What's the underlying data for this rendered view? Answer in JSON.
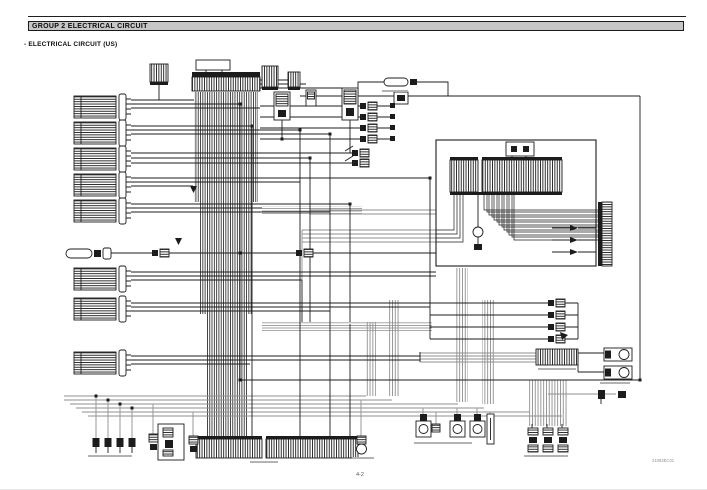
{
  "document": {
    "header_title": "GROUP 2 ELECTRICAL CIRCUIT",
    "section_title": "- ELECTRICAL CIRCUIT (US)",
    "page_number": "4-2",
    "drawing_code": "21092EC01"
  },
  "diagram": {
    "type": "electrical-wiring-schematic",
    "legible_component_text": false,
    "features": [
      "left column of multi-pin harness connector blocks",
      "central main harness connector with dense vertical wire bus",
      "relays, fuse links and in-line connector pairs",
      "control panel box with connector strips and wire bundle routed to a right-hand connector",
      "solenoid/motor cluster with stacked connector pairs",
      "bottom row of switches, sensors and wide connector strips"
    ]
  },
  "colors": {
    "paper": "#ffffff",
    "ink": "#1c1c1c",
    "wire_gray": "#8f8f8f",
    "header_bar_fill": "#c6c6c6"
  }
}
